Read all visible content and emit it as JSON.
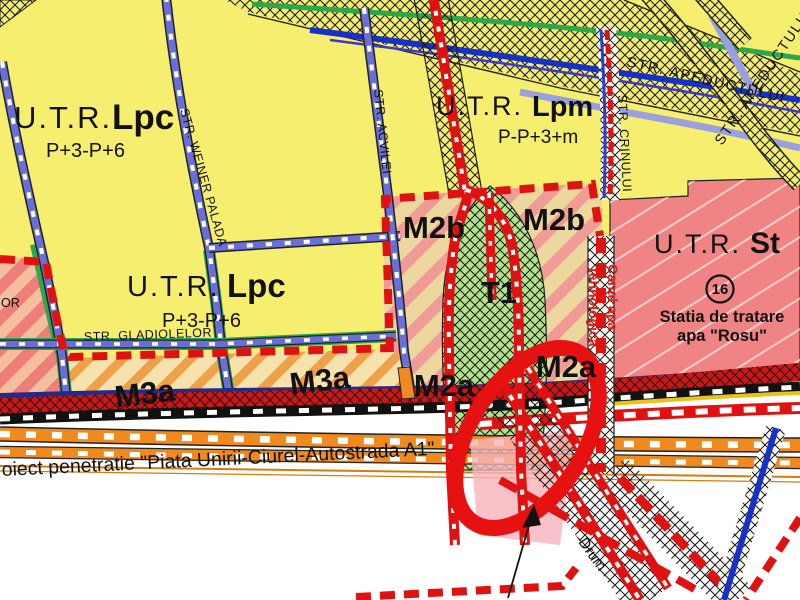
{
  "map": {
    "zones": {
      "lpc": {
        "utr": "U.T.R.",
        "code": "Lpc",
        "regime": "P+3-P+6"
      },
      "lpm": {
        "utr": "U.T.R.",
        "code": "Lpm",
        "regime": "P-P+3+m"
      },
      "st": {
        "utr": "U.T.R.",
        "code": "St",
        "number": "16",
        "name1": "Statia de tratare",
        "name2": "apa \"Rosu\""
      },
      "m2b": "M2b",
      "m2a": "M2a",
      "m3a": "M3a",
      "t1": "T1"
    },
    "streets": {
      "wiener_palada": "STR. WEINER PALADA",
      "acvilei": "STR. ACVILEI",
      "crinului": "STR. CRINULUI",
      "gladiolelor": "STR. GLADIOLELOR",
      "apeductului": "STR. APEDUCTULUI",
      "apeductului_upper": "STR. APEDUCTULUI",
      "partial_left": "OR"
    },
    "annotations": {
      "penetration": "oiect penetratie \"Piata Unirii-Ciurel-Autostrada A1\"",
      "canal1": "Canal apa",
      "canal2": "tehnologica",
      "drum": "Drum"
    },
    "colors": {
      "zone_yellow": "#f5ee6e",
      "zone_pink_st": "#f08484",
      "zone_green_t1": "#b2e38b",
      "stripe_salmon": "#f19b97",
      "stripe_tan": "#ecd89f",
      "stripe_orange": "#efa04b",
      "boundary_red": "#e01111",
      "road_orange": "#f08a1c",
      "street_blue": "#6a6fd8",
      "line_green": "#2ca84a",
      "line_blue": "#1630c8"
    }
  }
}
